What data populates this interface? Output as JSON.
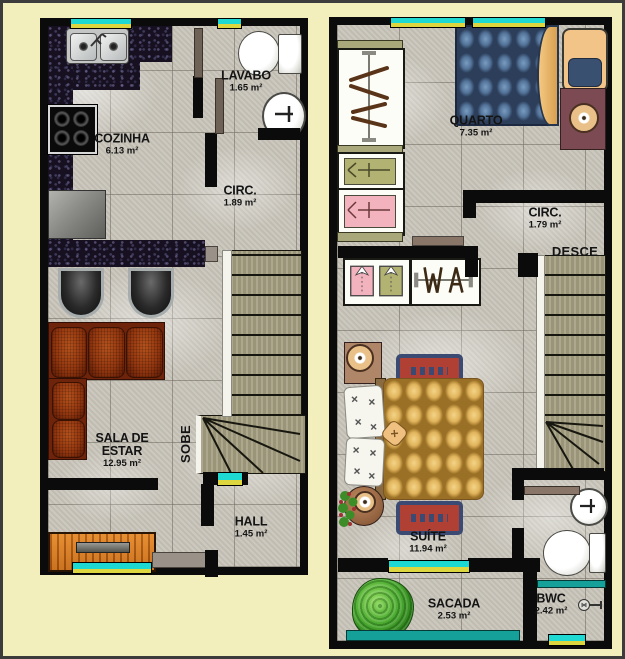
{
  "palette": {
    "background": "#f2efbd",
    "frame": "#3c3c3c",
    "wall": "#0b0b0b",
    "floor": "#c8c4ba",
    "window_glass": "#1ed8d2",
    "window_sill": "#ded63e",
    "granite_counter": "#161020",
    "sofa": "#94370f",
    "wood_cabinet": "#c46a16",
    "stair_tread": "#a49e80",
    "bed_quarto_blue": "#54749a",
    "bed_suite_tan": "#e0b45c",
    "rug_border": "#3a4a72",
    "rug_field": "#b04034",
    "tree_green": "#3c8c28",
    "balcony_rail_teal": "#16a09a",
    "wardrobe_green": "#b2b272",
    "wardrobe_pink": "#f2b2be"
  },
  "ground_floor": {
    "stair_label": "SOBE",
    "rooms": {
      "cozinha": {
        "name": "COZINHA",
        "area": "6.13 m²"
      },
      "lavabo": {
        "name": "LAVABO",
        "area": "1.65 m²"
      },
      "circ": {
        "name": "CIRC.",
        "area": "1.89 m²"
      },
      "sala": {
        "name_line1": "SALA DE",
        "name_line2": "ESTAR",
        "area": "12.95 m²"
      },
      "hall": {
        "name": "HALL",
        "area": "1.45 m²"
      }
    }
  },
  "upper_floor": {
    "stair_label": "DESCE",
    "rooms": {
      "quarto": {
        "name": "QUARTO",
        "area": "7.35 m²"
      },
      "circ": {
        "name": "CIRC.",
        "area": "1.79 m²"
      },
      "suite": {
        "name": "SUÍTE",
        "area": "11.94 m²"
      },
      "sacada": {
        "name": "SACADA",
        "area": "2.53 m²"
      },
      "bwc": {
        "name": "BWC",
        "area": "2.42 m²"
      }
    }
  }
}
